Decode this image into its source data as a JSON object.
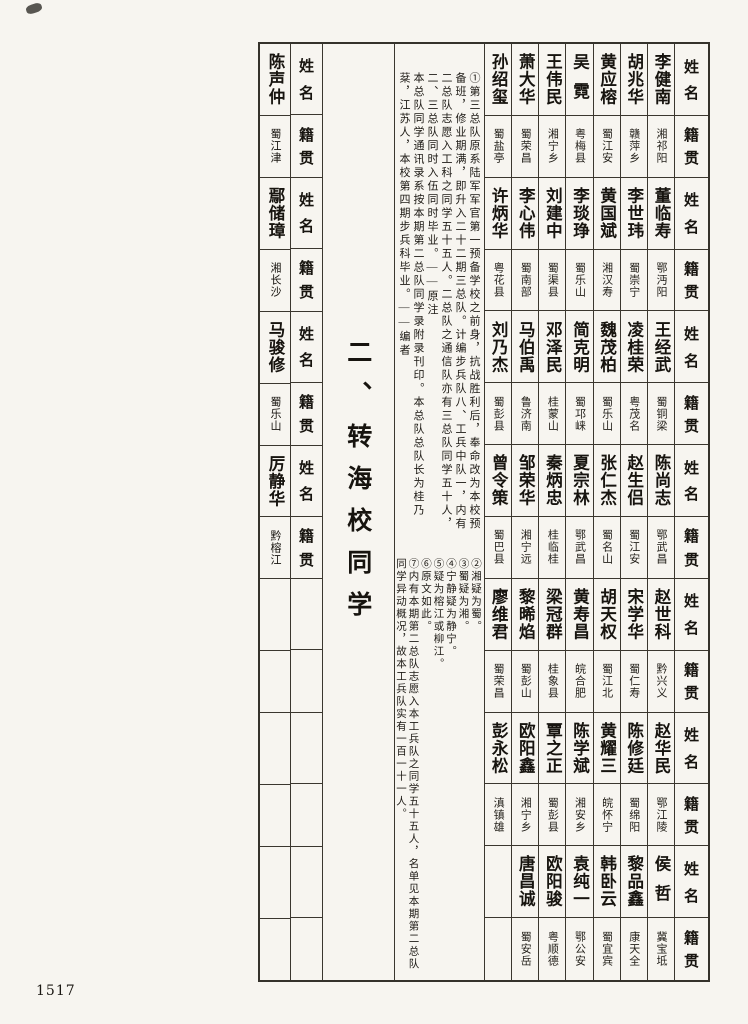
{
  "page": {
    "number": "1517",
    "title": "二、转海校同学"
  },
  "headers": {
    "name": "姓名",
    "place": "籍贯"
  },
  "roster": {
    "bands": [
      {
        "entries": [
          {
            "name": "李健南",
            "place": "湘祁阳"
          },
          {
            "name": "胡兆华",
            "place": "赣萍乡"
          },
          {
            "name": "黄应榕",
            "place": "蜀江安"
          },
          {
            "name": "吴霓",
            "place": "粤梅县"
          },
          {
            "name": "王伟民",
            "place": "湘宁乡"
          },
          {
            "name": "萧大华",
            "place": "蜀荣昌"
          },
          {
            "name": "孙绍玺",
            "place": "蜀盐亭"
          }
        ]
      },
      {
        "entries": [
          {
            "name": "董临寿",
            "place": "鄂沔阳"
          },
          {
            "name": "李世玮",
            "place": "蜀崇宁"
          },
          {
            "name": "黄国斌",
            "place": "湘汉寿"
          },
          {
            "name": "李琰琤",
            "place": "蜀乐山"
          },
          {
            "name": "刘建中",
            "place": "蜀渠县"
          },
          {
            "name": "李心伟",
            "place": "蜀南部"
          },
          {
            "name": "许炳华",
            "place": "粤花县"
          }
        ]
      },
      {
        "entries": [
          {
            "name": "王经武",
            "place": "蜀铜梁"
          },
          {
            "name": "凌桂荣",
            "place": "粤茂名"
          },
          {
            "name": "魏茂柏",
            "place": "蜀乐山"
          },
          {
            "name": "简克明",
            "place": "蜀邛崃"
          },
          {
            "name": "邓泽民",
            "place": "桂蒙山"
          },
          {
            "name": "马伯禹",
            "place": "鲁济南"
          },
          {
            "name": "刘乃杰",
            "place": "蜀彭县"
          }
        ]
      },
      {
        "entries": [
          {
            "name": "陈尚志",
            "place": "鄂武昌"
          },
          {
            "name": "赵生侣",
            "place": "蜀江安"
          },
          {
            "name": "张仁杰",
            "place": "蜀名山"
          },
          {
            "name": "夏宗林",
            "place": "鄂武昌"
          },
          {
            "name": "秦炳忠",
            "place": "桂临桂"
          },
          {
            "name": "邹荣华",
            "place": "湘宁远"
          },
          {
            "name": "曾令策",
            "place": "蜀巴县"
          }
        ]
      },
      {
        "entries": [
          {
            "name": "赵世科",
            "place": "黔兴义"
          },
          {
            "name": "宋学华",
            "place": "蜀仁寿"
          },
          {
            "name": "胡天权",
            "place": "蜀江北"
          },
          {
            "name": "黄寿昌",
            "place": "皖合肥"
          },
          {
            "name": "梁冠群",
            "place": "桂象县"
          },
          {
            "name": "黎晞焰",
            "place": "蜀彭山"
          },
          {
            "name": "廖维君",
            "place": "蜀荣昌"
          }
        ]
      },
      {
        "entries": [
          {
            "name": "赵华民",
            "place": "鄂江陵"
          },
          {
            "name": "陈修廷",
            "place": "蜀绵阳"
          },
          {
            "name": "黄耀三",
            "place": "皖怀宁"
          },
          {
            "name": "陈学斌",
            "place": "湘安乡"
          },
          {
            "name": "覃之正",
            "place": "蜀彭县"
          },
          {
            "name": "欧阳鑫",
            "place": "湘宁乡"
          },
          {
            "name": "彭永松",
            "place": "滇镇雄"
          }
        ]
      },
      {
        "entries": [
          {
            "name": "侯哲",
            "place": "冀宝坻"
          },
          {
            "name": "黎品鑫",
            "place": "康天全"
          },
          {
            "name": "韩卧云",
            "place": "蜀宜宾"
          },
          {
            "name": "袁纯一",
            "place": "鄂公安"
          },
          {
            "name": "欧阳骏",
            "place": "粤顺德"
          },
          {
            "name": "唐昌诚",
            "place": "蜀安岳"
          }
        ]
      }
    ]
  },
  "continuation": {
    "entries": [
      {
        "name": "陈声仲",
        "place": "蜀江津"
      },
      {
        "name": "鄢储璋",
        "place": "湘长沙"
      },
      {
        "name": "马骏修",
        "place": "蜀乐山"
      },
      {
        "name": "厉静华",
        "place": "黔榕江"
      }
    ]
  },
  "notes": {
    "upper": [
      "①第三总队原系陆军军官第一预备学校之前身，抗战胜利后，奉命改为本校预备班，修业期满，即升入二十二期三总队。计编步兵队八、工兵中队一，内有二总队志愿入工科之同学五十五人。二总队之通信队亦有三总队同学五十人，二、三总队同时入伍同时毕业。——原注",
      "本总队同学通讯录系按本期第二总队同学录附录刊印。本总队总队长为桂乃棻，江苏人，本校第四期步兵科毕业。——编者"
    ],
    "lower": [
      "②湘疑为蜀。",
      "③蜀疑为湘。",
      "④宁静疑为静宁。",
      "⑤疑为榕江或柳江。",
      "⑥原文如此。",
      "⑦内有本期第二总队志愿入本工兵队之同学五十五人，名单见本期第二总队同学异动概况，故本工兵队实有一百一十一人。"
    ]
  }
}
